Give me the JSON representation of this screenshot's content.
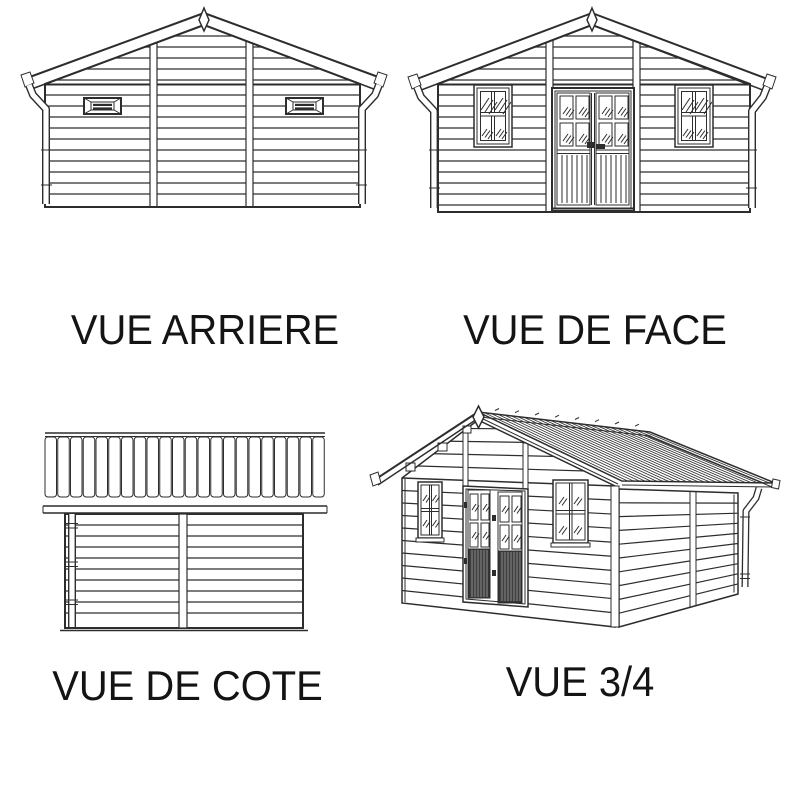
{
  "page": {
    "background": "#ffffff"
  },
  "colors": {
    "ink": "#2d2d2d",
    "text": "#141414",
    "door_panel_dark": "#3f3f3f",
    "door_panel_stripe": "#8a8a8a"
  },
  "views": [
    {
      "id": "rear",
      "label": "VUE ARRIERE"
    },
    {
      "id": "front",
      "label": "VUE DE FACE"
    },
    {
      "id": "side",
      "label": "VUE DE COTE"
    },
    {
      "id": "three-quarter",
      "label": "VUE 3/4"
    }
  ]
}
